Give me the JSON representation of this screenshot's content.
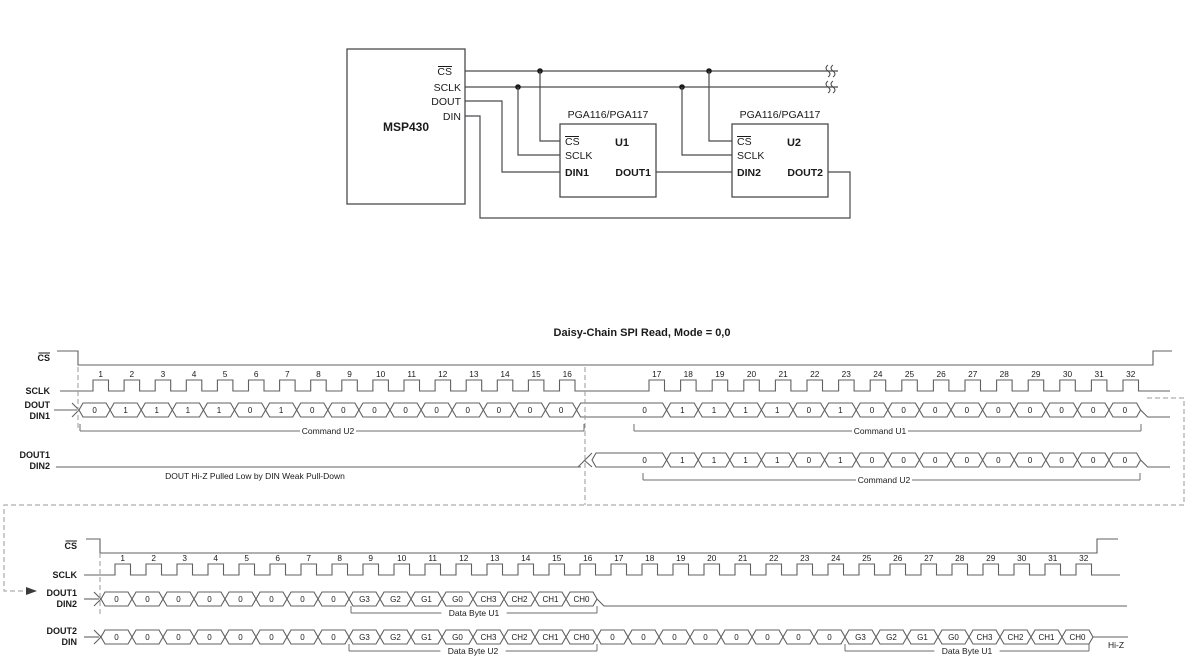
{
  "circuit": {
    "mcu": {
      "label": "MSP430",
      "pin_cs": "CS",
      "pin_sclk": "SCLK",
      "pin_dout": "DOUT",
      "pin_din": "DIN"
    },
    "u1": {
      "part": "PGA116/PGA117",
      "ref": "U1",
      "pin_cs": "CS",
      "pin_sclk": "SCLK",
      "pin_din": "DIN1",
      "pin_dout": "DOUT1"
    },
    "u2": {
      "part": "PGA116/PGA117",
      "ref": "U2",
      "pin_cs": "CS",
      "pin_sclk": "SCLK",
      "pin_din": "DIN2",
      "pin_dout": "DOUT2"
    }
  },
  "timing": {
    "title": "Daisy-Chain SPI Read, Mode = 0,0",
    "clock_numbers": [
      1,
      2,
      3,
      4,
      5,
      6,
      7,
      8,
      9,
      10,
      11,
      12,
      13,
      14,
      15,
      16,
      17,
      18,
      19,
      20,
      21,
      22,
      23,
      24,
      25,
      26,
      27,
      28,
      29,
      30,
      31,
      32
    ],
    "diagram1": {
      "sig_cs": "CS",
      "sig_sclk": "SCLK",
      "sig_row1": [
        "DOUT",
        "DIN1"
      ],
      "sig_row2": [
        "DOUT1",
        "DIN2"
      ],
      "row1_bits": [
        "0",
        "1",
        "1",
        "1",
        "1",
        "0",
        "1",
        "0",
        "0",
        "0",
        "0",
        "0",
        "0",
        "0",
        "0",
        "0",
        "0",
        "1",
        "1",
        "1",
        "1",
        "0",
        "1",
        "0",
        "0",
        "0",
        "0",
        "0",
        "0",
        "0",
        "0",
        "0"
      ],
      "row1_annotations": [
        "Command U2",
        "Command U1"
      ],
      "row2_bits": [
        "0",
        "1",
        "1",
        "1",
        "1",
        "0",
        "1",
        "0",
        "0",
        "0",
        "0",
        "0",
        "0",
        "0",
        "0",
        "0"
      ],
      "row2_annotation": "Command U2",
      "row2_note": "DOUT Hi-Z Pulled Low by DIN Weak Pull-Down"
    },
    "diagram2": {
      "sig_cs": "CS",
      "sig_sclk": "SCLK",
      "sig_row1": [
        "DOUT1",
        "DIN2"
      ],
      "sig_row2": [
        "DOUT2",
        "DIN"
      ],
      "row1_bits": [
        "0",
        "0",
        "0",
        "0",
        "0",
        "0",
        "0",
        "0",
        "G3",
        "G2",
        "G1",
        "G0",
        "CH3",
        "CH2",
        "CH1",
        "CH0"
      ],
      "row1_annotation": "Data Byte U1",
      "row2_bits": [
        "0",
        "0",
        "0",
        "0",
        "0",
        "0",
        "0",
        "0",
        "G3",
        "G2",
        "G1",
        "G0",
        "CH3",
        "CH2",
        "CH1",
        "CH0",
        "0",
        "0",
        "0",
        "0",
        "0",
        "0",
        "0",
        "0",
        "G3",
        "G2",
        "G1",
        "G0",
        "CH3",
        "CH2",
        "CH1",
        "CH0"
      ],
      "row2_annotations": [
        "Data Byte U2",
        "Data Byte U1"
      ],
      "hiz_label": "Hi-Z"
    }
  }
}
